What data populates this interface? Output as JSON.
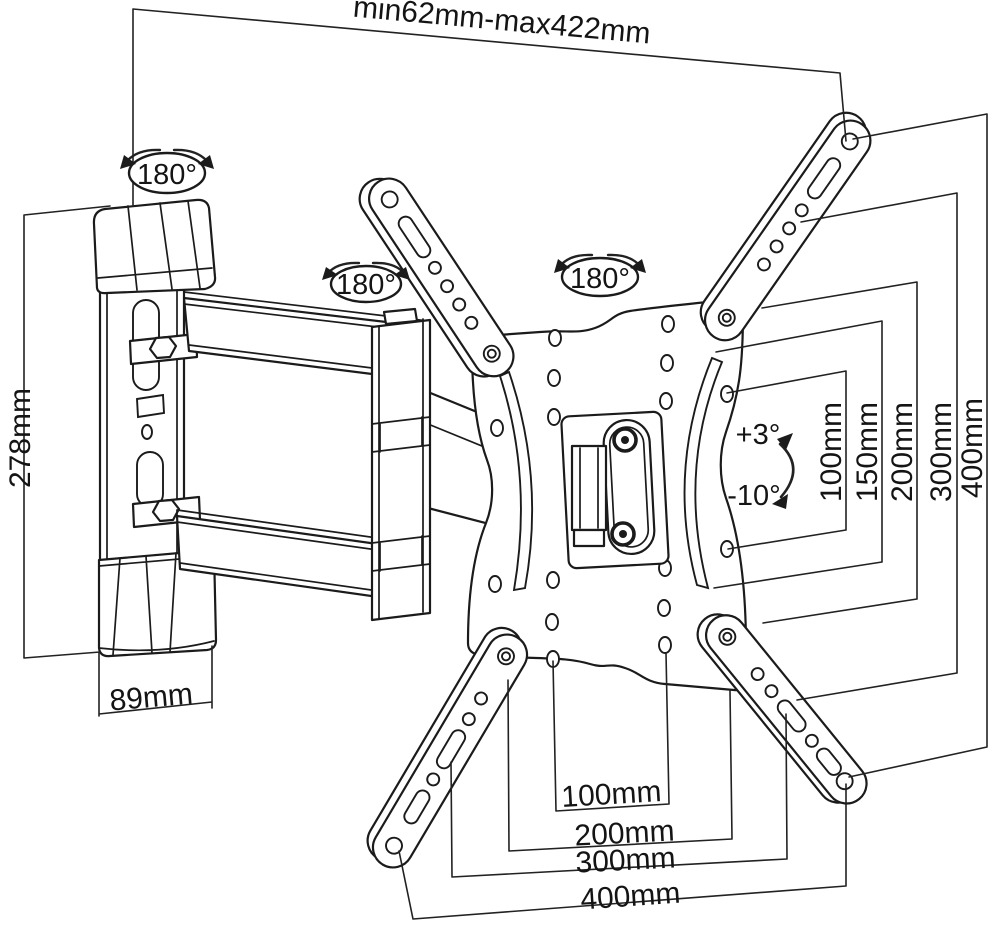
{
  "diagram": {
    "title": "Articulating TV wall mount dimensional diagram",
    "top_dim": "min62mm-max422mm",
    "left_dim": "278mm",
    "width_dim": "89mm",
    "rotation_labels": [
      "180°",
      "180°",
      "180°"
    ],
    "tilt": {
      "up": "+3°",
      "down": "-10°"
    },
    "vesa_vertical": [
      "100mm",
      "150mm",
      "200mm",
      "300mm",
      "400mm"
    ],
    "vesa_horizontal": [
      "100mm",
      "200mm",
      "300mm",
      "400mm"
    ]
  },
  "colors": {
    "line": "#1b1b1b",
    "background": "#ffffff"
  }
}
